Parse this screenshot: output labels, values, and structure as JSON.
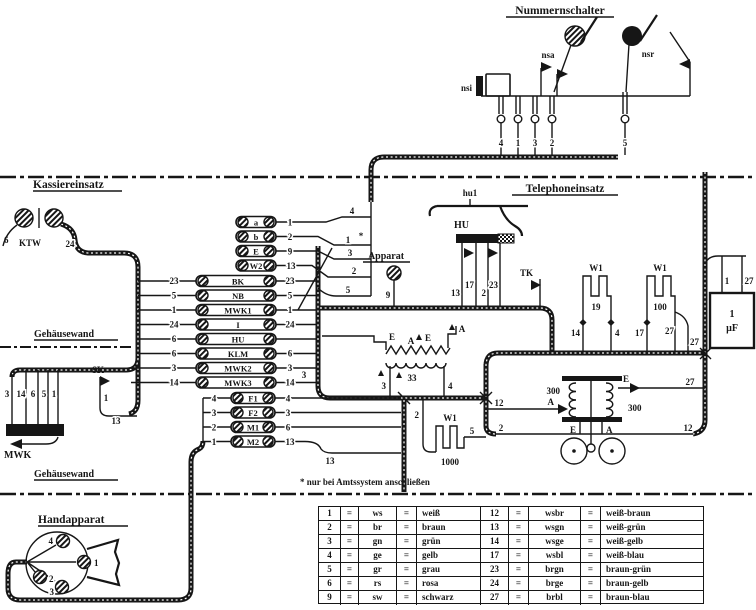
{
  "titles": {
    "nummernschalter": "Nummernschalter",
    "kassiereinsatz": "Kassiereinsatz",
    "telephoneinsatz": "Telephoneinsatz",
    "handapparat": "Handapparat",
    "apparat": "Apparat",
    "gehaeusewand_top": "Gehäusewand",
    "gehaeusewand_bottom": "Gehäusewand"
  },
  "footnote": "* nur bei Amtssystem anschließen",
  "nummernschalter": {
    "contacts": {
      "nsi": "nsi",
      "nsa": "nsa",
      "nsr": "nsr"
    },
    "terminals": [
      "4",
      "1",
      "3",
      "2",
      "5"
    ]
  },
  "kassiereinsatz": {
    "relay": "KTW",
    "wire_left": "6",
    "wire_right": "24"
  },
  "mwk": {
    "label": "MWK",
    "wires": [
      "3",
      "14",
      "6",
      "5",
      "1"
    ]
  },
  "sk": {
    "label": "SK",
    "wire_top": "1",
    "wire_bottom": "13"
  },
  "strip": {
    "short_rows": [
      {
        "label": "a",
        "num": "1",
        "riser": "4",
        "star": ""
      },
      {
        "label": "b",
        "num": "2",
        "riser": "1",
        "star": "*"
      },
      {
        "label": "E",
        "num": "9",
        "riser": "3",
        "star": ""
      },
      {
        "label": "W2",
        "num": "13",
        "riser": "2",
        "star": ""
      }
    ],
    "bk_riser": "5",
    "long_rows": [
      {
        "label": "BK",
        "left": "23",
        "right": "23"
      },
      {
        "label": "NB",
        "left": "5",
        "right": "5"
      },
      {
        "label": "MWK1",
        "left": "1",
        "right": "1"
      },
      {
        "label": "I",
        "left": "24",
        "right": "24"
      },
      {
        "label": "HU",
        "left": "6",
        "right": ""
      },
      {
        "label": "KLM",
        "left": "6",
        "right": "6"
      },
      {
        "label": "MWK2",
        "left": "3",
        "right": "3"
      },
      {
        "label": "MWK3",
        "left": "14",
        "right": "14"
      }
    ],
    "handset_rows": [
      {
        "label": "F1",
        "left": "4",
        "right": "4"
      },
      {
        "label": "F2",
        "left": "3",
        "right": "3"
      },
      {
        "label": "M1",
        "left": "2",
        "right": "6"
      },
      {
        "label": "M2",
        "left": "1",
        "right": "13",
        "extra": "13"
      }
    ]
  },
  "apparat": {
    "wire": "9"
  },
  "telephoneinsatz": {
    "hu": {
      "label": "HU",
      "contact": "hu1",
      "wires": [
        "13",
        "17",
        "2",
        "23"
      ]
    },
    "tk": "TK",
    "transformer": {
      "id": "33",
      "t_left": "3",
      "t_right": "4",
      "e1": "E",
      "a1": "A",
      "e2": "E",
      "a2": "A"
    },
    "r1000": {
      "label": "W1",
      "value": "1000",
      "w_in": "2",
      "w_mid": "5",
      "w_out": "2"
    },
    "r19": {
      "label": "W1",
      "value": "19",
      "left": "14",
      "right": "4"
    },
    "r100": {
      "label": "W1",
      "value": "100",
      "left": "17",
      "right": "27",
      "branch": "27"
    },
    "cap": {
      "t1": "1",
      "t2": "27",
      "line1": "1",
      "line2": "µF"
    },
    "receiver": {
      "coil_left": "300",
      "coil_right": "300",
      "w_upper_left": "12",
      "w_upper_right": "27",
      "w_lower_left": "2",
      "w_lower_right": "12",
      "a_left": "A",
      "e_right": "E",
      "e_bottom": "E",
      "a_bottom": "A"
    }
  },
  "handapparat": {
    "t1": "4",
    "t2": "1",
    "t3": "2",
    "t4": "3"
  },
  "table": {
    "eq": "=",
    "rows": [
      [
        "1",
        "ws",
        "weiß",
        "12",
        "wsbr",
        "weiß-braun"
      ],
      [
        "2",
        "br",
        "braun",
        "13",
        "wsgn",
        "weiß-grün"
      ],
      [
        "3",
        "gn",
        "grün",
        "14",
        "wsge",
        "weiß-gelb"
      ],
      [
        "4",
        "ge",
        "gelb",
        "17",
        "wsbl",
        "weiß-blau"
      ],
      [
        "5",
        "gr",
        "grau",
        "23",
        "brgn",
        "braun-grün"
      ],
      [
        "6",
        "rs",
        "rosa",
        "24",
        "brge",
        "braun-gelb"
      ],
      [
        "9",
        "sw",
        "schwarz",
        "27",
        "brbl",
        "braun-blau"
      ]
    ]
  }
}
